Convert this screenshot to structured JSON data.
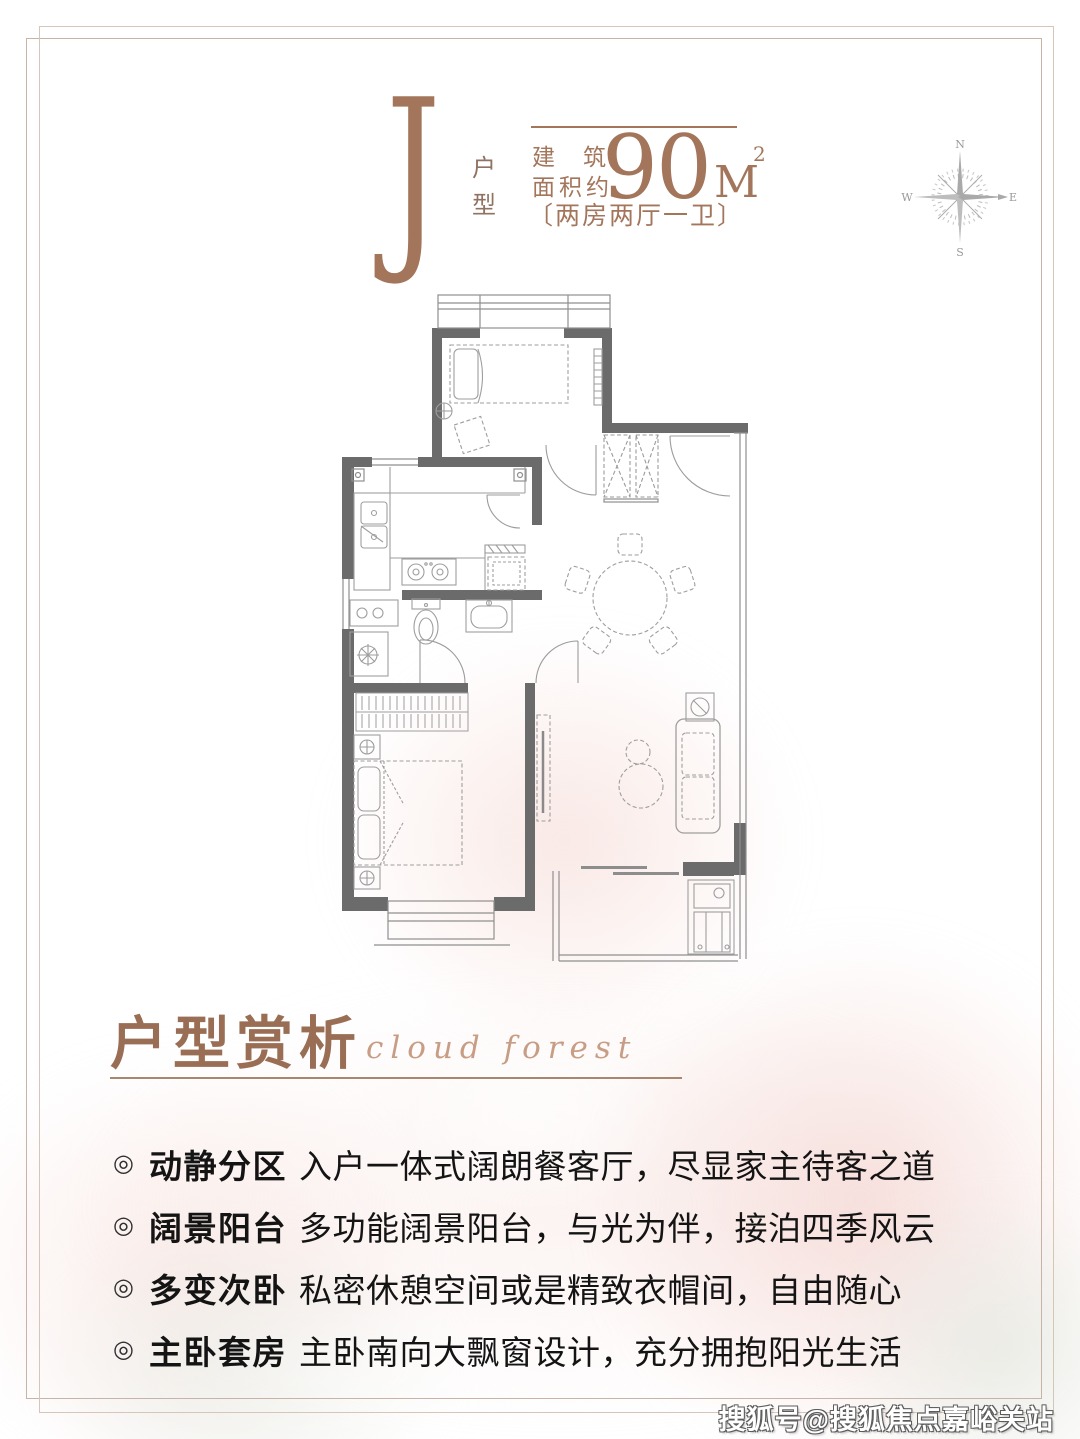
{
  "header": {
    "unit_letter": "J",
    "unit_type": "户型",
    "area_label_top": "建筑",
    "area_label_bottom": "面积约",
    "area_value": "90",
    "area_unit": "M",
    "area_power": "2",
    "rooms_label": "〔两房两厅一卫〕"
  },
  "compass": {
    "n": "N",
    "e": "E",
    "s": "S",
    "w": "W"
  },
  "section": {
    "title": "户型赏析",
    "subtitle_script": "cloud forest"
  },
  "features": {
    "bullet_glyph": "◎",
    "items": [
      {
        "term": "动静分区",
        "desc": "入户一体式阔朗餐客厅，尽显家主待客之道"
      },
      {
        "term": "阔景阳台",
        "desc": "多功能阔景阳台，与光为伴，接泊四季风云"
      },
      {
        "term": "多变次卧",
        "desc": "私密休憩空间或是精致衣帽间，自由随心"
      },
      {
        "term": "主卧套房",
        "desc": "主卧南向大飘窗设计，充分拥抱阳光生活"
      }
    ]
  },
  "watermark": "搜狐号@搜狐焦点嘉峪关站",
  "colors": {
    "accent_brown": "#a3765c",
    "heading_brown": "#996e55",
    "text_dark": "#141414",
    "wall_gray": "#6b6b6b",
    "plan_line_gray": "#9a9a9a",
    "frame_line": "#c7b4a6",
    "rose_pink": "#f2d0cb"
  }
}
